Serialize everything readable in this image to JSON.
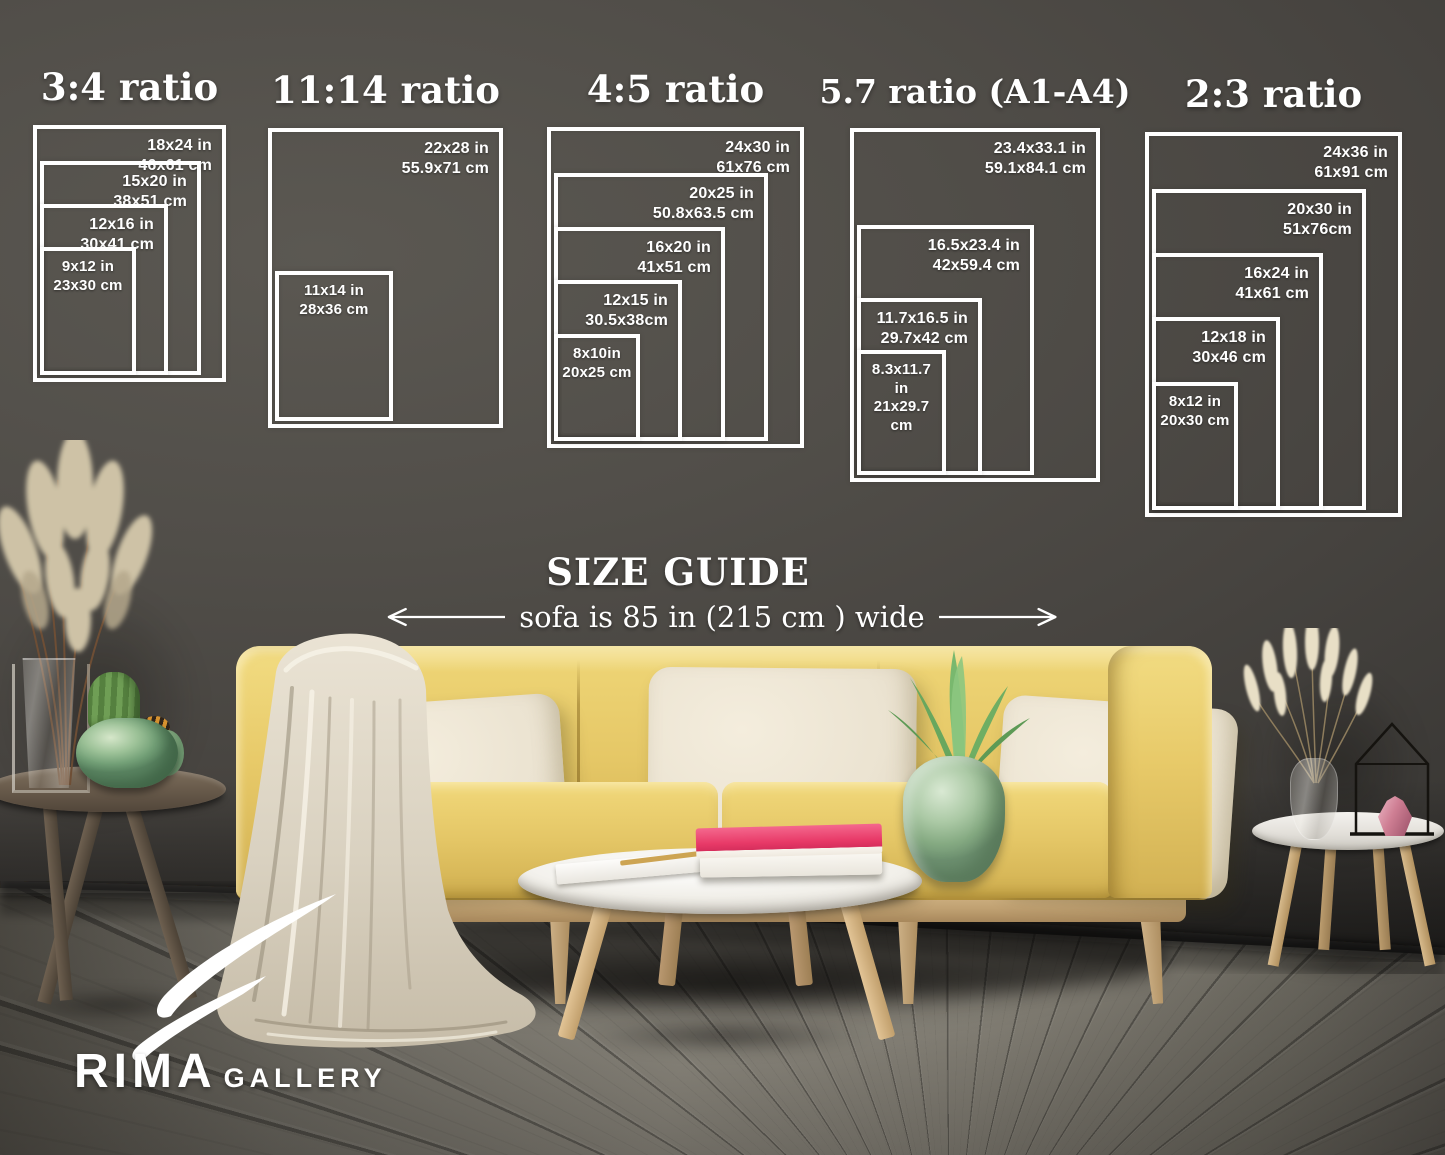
{
  "ratio_groups": [
    {
      "title": "3:4 ratio",
      "sizes": [
        {
          "inches": "18x24 in",
          "cm": "46x61 cm"
        },
        {
          "inches": "15x20 in",
          "cm": "38x51 cm"
        },
        {
          "inches": "12x16 in",
          "cm": "30x41 cm"
        },
        {
          "inches": "9x12 in",
          "cm": "23x30 cm"
        }
      ]
    },
    {
      "title": "11:14 ratio",
      "sizes": [
        {
          "inches": "22x28 in",
          "cm": "55.9x71 cm"
        },
        {
          "inches": "11x14 in",
          "cm": "28x36 cm"
        }
      ]
    },
    {
      "title": "4:5 ratio",
      "sizes": [
        {
          "inches": "24x30 in",
          "cm": "61x76 cm"
        },
        {
          "inches": "20x25 in",
          "cm": "50.8x63.5 cm"
        },
        {
          "inches": "16x20 in",
          "cm": "41x51 cm"
        },
        {
          "inches": "12x15 in",
          "cm": "30.5x38cm"
        },
        {
          "inches": "8x10in",
          "cm": "20x25 cm"
        }
      ]
    },
    {
      "title": "5.7 ratio (A1-A4)",
      "sizes": [
        {
          "inches": "23.4x33.1 in",
          "cm": "59.1x84.1 cm"
        },
        {
          "inches": "16.5x23.4 in",
          "cm": "42x59.4 cm"
        },
        {
          "inches": "11.7x16.5 in",
          "cm": "29.7x42 cm"
        },
        {
          "inches": "8.3x11.7 in",
          "cm": "21x29.7 cm"
        }
      ]
    },
    {
      "title": "2:3 ratio",
      "sizes": [
        {
          "inches": "24x36 in",
          "cm": "61x91 cm"
        },
        {
          "inches": "20x30 in",
          "cm": "51x76cm"
        },
        {
          "inches": "16x24 in",
          "cm": "41x61 cm"
        },
        {
          "inches": "12x18 in",
          "cm": "30x46 cm"
        },
        {
          "inches": "8x12 in",
          "cm": "20x30 cm"
        }
      ]
    }
  ],
  "size_guide": {
    "title": "SIZE GUIDE",
    "sofa_note": "sofa is 85 in (215 cm ) wide"
  },
  "logo": {
    "brand": "RIMA",
    "suffix": "GALLERY"
  },
  "colors": {
    "diagram_line": "#ffffff",
    "wall": "#47443f",
    "floor": "#837f75",
    "sofa_yellow": "#e5c766",
    "pillow_cream": "#ebe3d1",
    "book_pink": "#e83a68",
    "pot_green": "#9dc298"
  }
}
